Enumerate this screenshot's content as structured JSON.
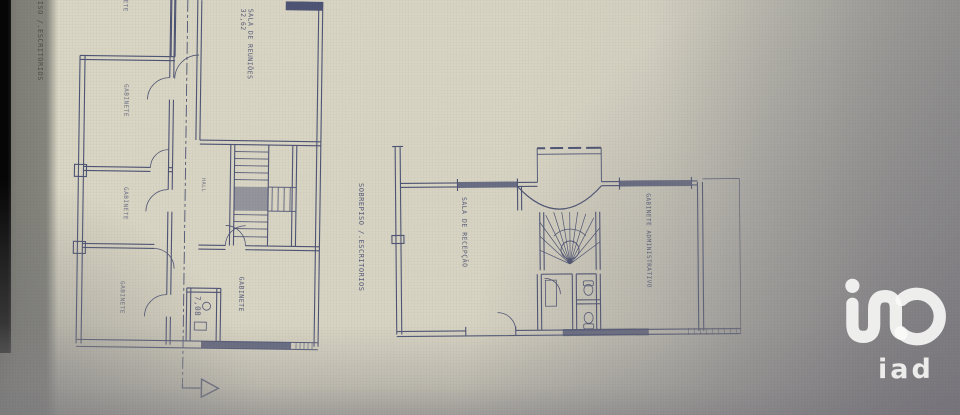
{
  "photo": {
    "left_margin_label": "PISO /.ESCRITORIOS"
  },
  "first_floor_plan": {
    "rooms": {
      "room_top_cut": "GABINETE",
      "room_a": "GABINETE",
      "room_b": "GABINETE",
      "room_c": "GABINETE",
      "meeting_room": "SALA DE REUNIÕES",
      "meeting_room_area": "32,62",
      "office": "GABINETE",
      "hall": "HALL",
      "dimension": "7,08"
    }
  },
  "mezzanine_plan": {
    "axis_label": "SOBREPISO /.ESCRITORIOS",
    "rooms": {
      "reception": "SALA DE RECEPÇÃO",
      "admin_office": "GABINETE ADMINISTRATIVO"
    }
  },
  "logo": {
    "brand": "iad"
  },
  "colors": {
    "paper": "#d8d4c3",
    "ink": "#3b4269",
    "margin_strip": "#85857d",
    "edge_black": "#0a0a0a",
    "photo_gray": "#8d8c90",
    "logo_white": "#f3f2f0"
  }
}
